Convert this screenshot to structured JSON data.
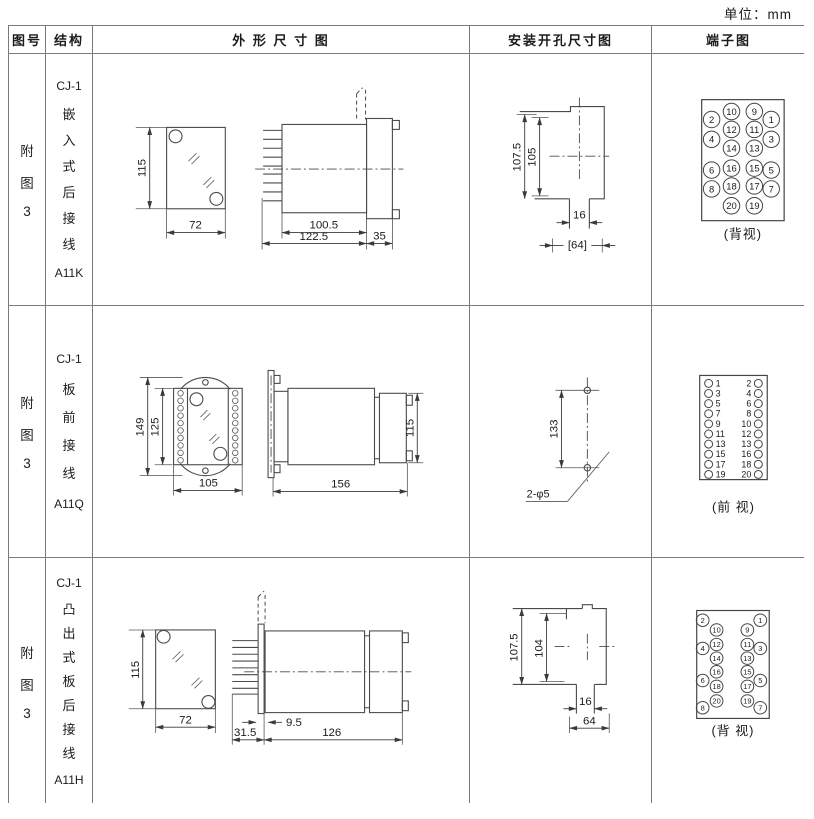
{
  "unit_label": "单位：mm",
  "header": {
    "col_fig": "图号",
    "col_struct": "结构",
    "col_outline": "外 形 尺 寸 图",
    "col_mount": "安装开孔尺寸图",
    "col_term": "端子图"
  },
  "rows": [
    {
      "fig": [
        "附",
        "图",
        "3"
      ],
      "struct": {
        "model": "CJ-1",
        "chars": [
          "嵌",
          "入",
          "式",
          "后",
          "接",
          "线"
        ],
        "code": "A11K"
      },
      "outline_dims": {
        "h": "115",
        "w": "72",
        "body": "100.5",
        "overall": "122.5",
        "flange": "35"
      },
      "mount_dims": {
        "a": "107.5",
        "b": "105",
        "slot": "16",
        "w": "[64]"
      },
      "terminal": {
        "outer_left": [
          "2",
          "4",
          "6",
          "8"
        ],
        "inner_left": [
          "10",
          "12",
          "14",
          "16",
          "18",
          "20"
        ],
        "inner_right": [
          "9",
          "11",
          "13",
          "15",
          "17",
          "19"
        ],
        "outer_right": [
          "1",
          "3",
          "5",
          "7"
        ],
        "caption": "(背视)"
      }
    },
    {
      "fig": [
        "附",
        "图",
        "3"
      ],
      "struct": {
        "model": "CJ-1",
        "chars": [
          "板",
          "前",
          "接",
          "线"
        ],
        "code": "A11Q"
      },
      "outline_dims": {
        "a": "149",
        "b": "125",
        "w": "105",
        "len": "156",
        "h": "115"
      },
      "mount_dims": {
        "spacing": "133",
        "holes": "2-φ5"
      },
      "terminal": {
        "left": [
          "1",
          "3",
          "5",
          "7",
          "9",
          "11",
          "13",
          "15",
          "17",
          "19"
        ],
        "right": [
          "2",
          "4",
          "6",
          "8",
          "10",
          "12",
          "13",
          "16",
          "18",
          "20"
        ],
        "caption": "(前 视)"
      }
    },
    {
      "fig": [
        "附",
        "图",
        "3"
      ],
      "struct": {
        "model": "CJ-1",
        "chars": [
          "凸",
          "出",
          "式",
          "板",
          "后",
          "接",
          "线"
        ],
        "code": "A11H"
      },
      "outline_dims": {
        "h": "115",
        "w": "72",
        "pins": "31.5",
        "gap": "9.5",
        "len": "126"
      },
      "mount_dims": {
        "a": "107.5",
        "b": "104",
        "slot": "16",
        "w": "64"
      },
      "terminal": {
        "outer_left": [
          "2",
          "4",
          "6",
          "8"
        ],
        "inner_left": [
          "10",
          "12",
          "14",
          "16",
          "18",
          "20"
        ],
        "inner_right": [
          "9",
          "11",
          "13",
          "15",
          "17",
          "19"
        ],
        "outer_right": [
          "1",
          "3",
          "5",
          "7"
        ],
        "caption": "(背 视)"
      }
    }
  ]
}
